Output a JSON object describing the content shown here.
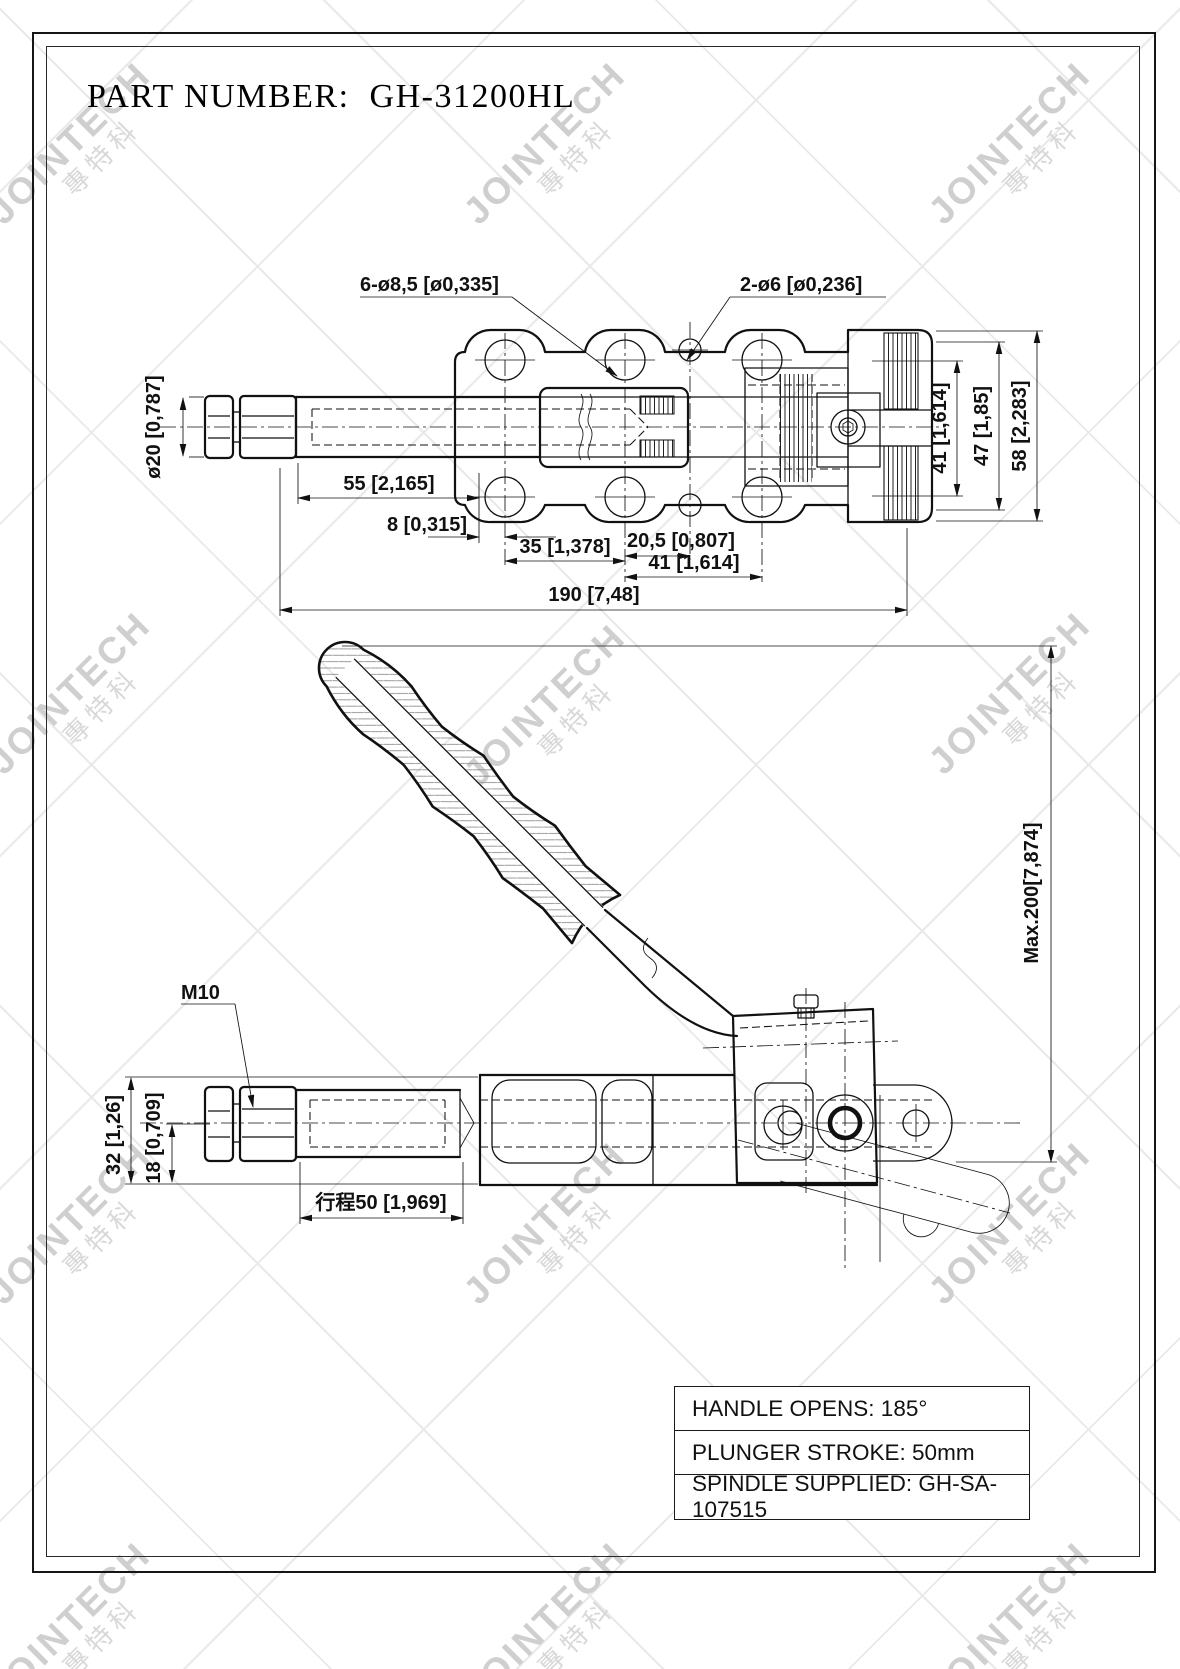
{
  "page": {
    "title": "PART NUMBER:  GH-31200HL"
  },
  "watermark": {
    "brand": "JOINTECH",
    "cjk": "專特科"
  },
  "top_view": {
    "callout_large_holes": "6-ø8,5 [ø0,335]",
    "callout_small_holes": "2-ø6 [ø0,236]",
    "dim_spindle_dia": "ø20 [0,787]",
    "dim_55": "55 [2,165]",
    "dim_8": "8 [0,315]",
    "dim_35": "35 [1,378]",
    "dim_20_5": "20,5 [0,807]",
    "dim_41_bottom": "41 [1,614]",
    "dim_190": "190 [7,48]",
    "dim_41_right": "41 [1,614]",
    "dim_47": "47 [1,85]",
    "dim_58": "58 [2,283]"
  },
  "side_view": {
    "callout_thread": "M10",
    "dim_32": "32 [1,26]",
    "dim_18": "18 [0,709]",
    "dim_stroke": "行程50 [1,969]",
    "dim_max_open": "Max.200[7,874]"
  },
  "spec_table": {
    "rows": [
      {
        "label": "HANDLE OPENS: 185°"
      },
      {
        "label": "PLUNGER STROKE: 50mm"
      },
      {
        "label": "SPINDLE SUPPLIED: GH-SA-107515"
      }
    ]
  },
  "colors": {
    "line": "#111111",
    "watermark_text": "#cfcfcf",
    "lattice": "#e9e9e9",
    "paper": "#ffffff"
  }
}
